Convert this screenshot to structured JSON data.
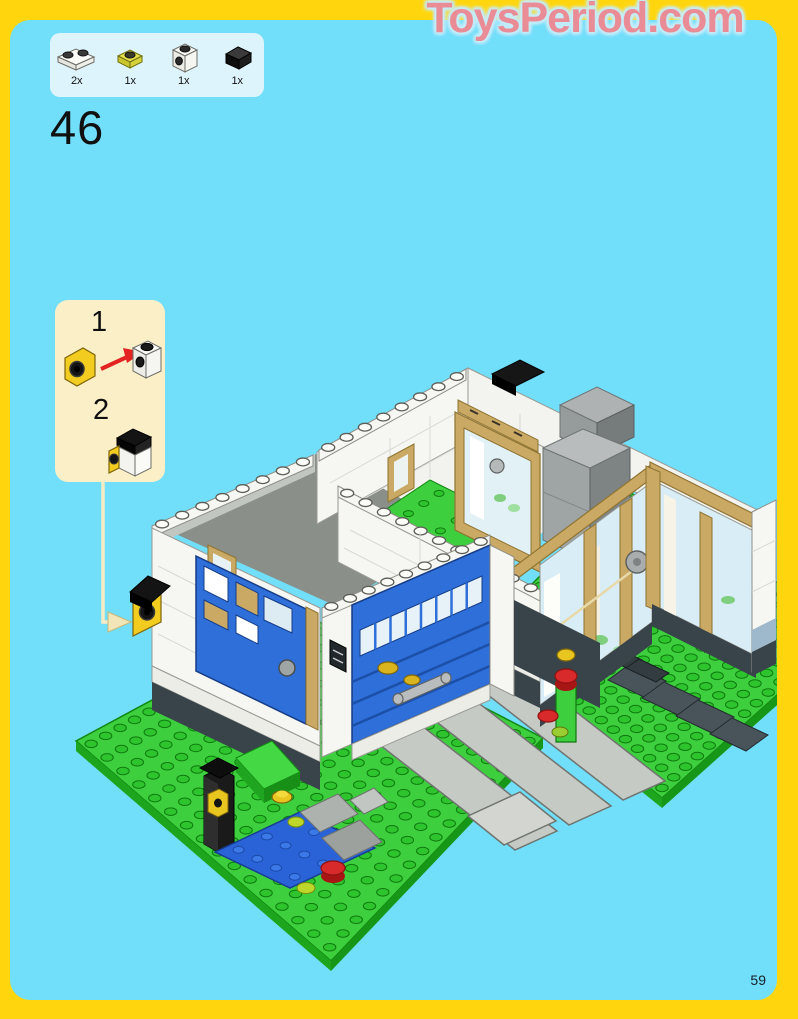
{
  "watermark": {
    "text": "ToysPeriod.com"
  },
  "step": {
    "number": "46"
  },
  "page": {
    "number": "59"
  },
  "parts_panel": {
    "items": [
      {
        "qty": "2x",
        "part": "white-plate-1x2"
      },
      {
        "qty": "1x",
        "part": "yellow-plate-1x1"
      },
      {
        "qty": "1x",
        "part": "white-headlight-brick-1x1"
      },
      {
        "qty": "1x",
        "part": "black-slope-1x1"
      }
    ]
  },
  "callout": {
    "steps": [
      {
        "label": "1"
      },
      {
        "label": "2"
      }
    ]
  },
  "colors": {
    "page_border": "#FFD60E",
    "page_background": "#71DEFA",
    "watermark_pink": "#EA8C95",
    "parts_box_background": "#DEF4FC",
    "callout_background": "#FBEFC7",
    "baseplate_green": "#3ECF3E",
    "wall_white": "#F6F6F2",
    "door_blue": "#2E6FD9",
    "window_frame_tan": "#C9A964",
    "chimney_gray": "#9FA4A4",
    "pond_blue": "#2A63D8",
    "arrow_red": "#E32222",
    "leader_cream": "#F5EBC4"
  }
}
